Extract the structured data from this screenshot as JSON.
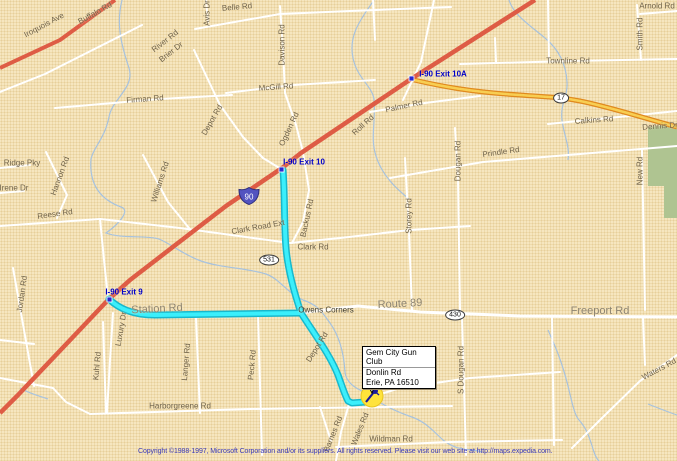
{
  "map": {
    "colors": {
      "background": "#F6E6BF",
      "local_road": "#FFFFFF",
      "interstate": "#DE5C45",
      "route17_casing": "#E08A1E",
      "route17_fill": "#F8CE52",
      "route_highlight": "#3BEFFB",
      "route_highlight_casing": "#18B8CC",
      "stream": "#A7C2DE",
      "park_green": "#AFC491",
      "label": "#6E6148",
      "exit_label": "#0000C8",
      "marker_halo": "#FFE33B",
      "copyright_text": "#3939B8"
    },
    "callout": {
      "title": "Gem City Gun Club",
      "address_line1": "Donlin Rd",
      "address_line2": "Erie, PA 16510"
    },
    "shields": [
      {
        "label": "90",
        "type": "interstate",
        "x": 249,
        "y": 196
      },
      {
        "label": "531",
        "type": "oval",
        "x": 269,
        "y": 260
      },
      {
        "label": "430",
        "type": "oval",
        "x": 455,
        "y": 315
      },
      {
        "label": "17",
        "type": "oval",
        "x": 561,
        "y": 98
      }
    ],
    "labels": [
      {
        "t": "Buffalo Rd",
        "x": 95,
        "y": 13,
        "r": -29
      },
      {
        "t": "Iroquois Ave",
        "x": 44,
        "y": 25,
        "r": -28
      },
      {
        "t": "Avis Dr",
        "x": 207,
        "y": 13,
        "r": -90
      },
      {
        "t": "Belle Rd",
        "x": 237,
        "y": 7,
        "r": -5
      },
      {
        "t": "River Rd",
        "x": 165,
        "y": 41,
        "r": -38
      },
      {
        "t": "Brier Dr",
        "x": 171,
        "y": 52,
        "r": -38
      },
      {
        "t": "Davison Rd",
        "x": 282,
        "y": 45,
        "r": -90
      },
      {
        "t": "Firman Rd",
        "x": 145,
        "y": 99,
        "r": -4
      },
      {
        "t": "McGill Rd",
        "x": 276,
        "y": 87,
        "r": -4
      },
      {
        "t": "Townline Rd",
        "x": 568,
        "y": 61,
        "r": 0
      },
      {
        "t": "Arnold Rd",
        "x": 657,
        "y": 6,
        "r": 0
      },
      {
        "t": "Smith Rd",
        "x": 640,
        "y": 34,
        "r": -90
      },
      {
        "t": "Palmer Rd",
        "x": 404,
        "y": 106,
        "r": -12
      },
      {
        "t": "Roll Rd",
        "x": 363,
        "y": 125,
        "r": -42
      },
      {
        "t": "Ogden Rd",
        "x": 289,
        "y": 129,
        "r": -65
      },
      {
        "t": "Depot Rd",
        "x": 212,
        "y": 120,
        "r": -60
      },
      {
        "t": "Calkins Rd",
        "x": 594,
        "y": 120,
        "r": -4
      },
      {
        "t": "Dennis Dr",
        "x": 660,
        "y": 126,
        "r": -4
      },
      {
        "t": "Prindle Rd",
        "x": 501,
        "y": 152,
        "r": -8
      },
      {
        "t": "Ridge Pky",
        "x": 22,
        "y": 163,
        "r": 0
      },
      {
        "t": "Irene Dr",
        "x": 14,
        "y": 188,
        "r": 0
      },
      {
        "t": "Hannon Rd",
        "x": 60,
        "y": 176,
        "r": -70
      },
      {
        "t": "Williams Rd",
        "x": 160,
        "y": 182,
        "r": -72
      },
      {
        "t": "Reese Rd",
        "x": 55,
        "y": 214,
        "r": -8
      },
      {
        "t": "Jordan Rd",
        "x": 22,
        "y": 294,
        "r": -82
      },
      {
        "t": "I-90 Exit 10A",
        "x": 443,
        "y": 74,
        "r": 0,
        "cls": "exit"
      },
      {
        "t": "I-90 Exit 10",
        "x": 304,
        "y": 162,
        "r": 0,
        "cls": "exit"
      },
      {
        "t": "I-90 Exit 9",
        "x": 124,
        "y": 292,
        "r": 0,
        "cls": "exit"
      },
      {
        "t": "Clark Road Ext",
        "x": 258,
        "y": 227,
        "r": -10
      },
      {
        "t": "Backus Rd",
        "x": 307,
        "y": 218,
        "r": -78
      },
      {
        "t": "Clark Rd",
        "x": 313,
        "y": 247,
        "r": 0
      },
      {
        "t": "Storey Rd",
        "x": 409,
        "y": 216,
        "r": -90
      },
      {
        "t": "Dougan Rd",
        "x": 458,
        "y": 161,
        "r": -90
      },
      {
        "t": "New Rd",
        "x": 640,
        "y": 171,
        "r": -90
      },
      {
        "t": "Station Rd",
        "x": 157,
        "y": 309,
        "r": -3,
        "cls": "major"
      },
      {
        "t": "Route 89",
        "x": 400,
        "y": 304,
        "r": -3,
        "cls": "major"
      },
      {
        "t": "Owens Corners",
        "x": 326,
        "y": 310,
        "r": 0,
        "cls": "place"
      },
      {
        "t": "Luxury Dr",
        "x": 121,
        "y": 329,
        "r": -80
      },
      {
        "t": "Kuhl Rd",
        "x": 97,
        "y": 366,
        "r": -85
      },
      {
        "t": "Langer Rd",
        "x": 186,
        "y": 362,
        "r": -85
      },
      {
        "t": "Peck Rd",
        "x": 252,
        "y": 365,
        "r": -85
      },
      {
        "t": "Depot Rd",
        "x": 317,
        "y": 347,
        "r": -58
      },
      {
        "t": "Freeport Rd",
        "x": 600,
        "y": 311,
        "r": 0,
        "cls": "major"
      },
      {
        "t": "S Dougan Rd",
        "x": 461,
        "y": 370,
        "r": -90
      },
      {
        "t": "Donlin Rd",
        "x": 399,
        "y": 381,
        "r": -8
      },
      {
        "t": "Harborgreene Rd",
        "x": 180,
        "y": 406,
        "r": 0
      },
      {
        "t": "Wildman Rd",
        "x": 391,
        "y": 439,
        "r": 0
      },
      {
        "t": "Barnes Rd",
        "x": 333,
        "y": 434,
        "r": -68
      },
      {
        "t": "Wales Rd",
        "x": 360,
        "y": 429,
        "r": -68
      },
      {
        "t": "Waters Rd",
        "x": 659,
        "y": 369,
        "r": -28
      }
    ],
    "copyright": "Copyright ©1988-1997, Microsoft Corporation and/or its suppliers. All rights reserved. Please visit our web site at http://maps.expedia.com."
  }
}
